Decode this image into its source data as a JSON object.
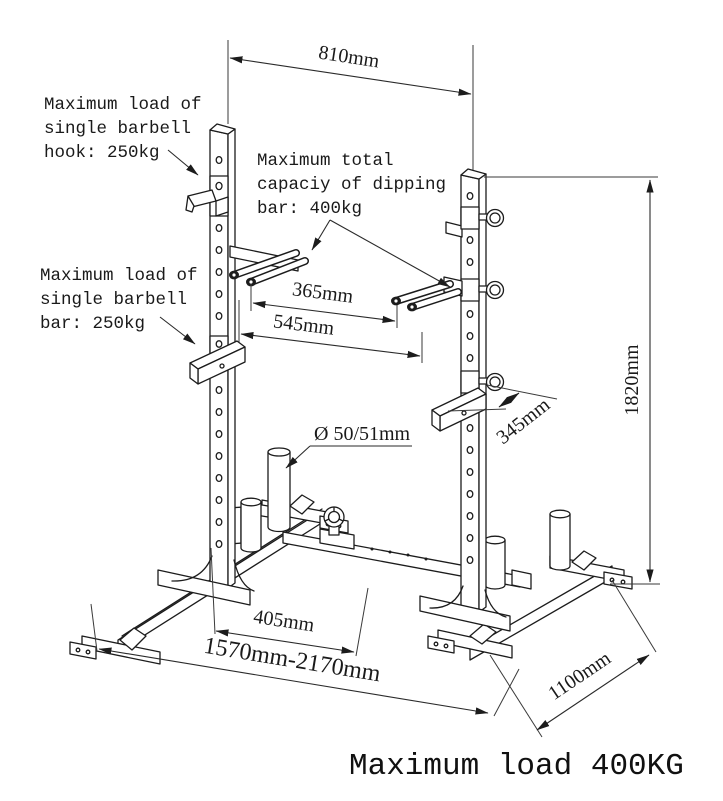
{
  "diagram_title": "squat rack dimension drawing",
  "colors": {
    "line": "#1c1c1c",
    "dimension": "#2a2a2a",
    "background": "#ffffff",
    "text": "#1a1a1a"
  },
  "labels": {
    "hook_load": {
      "lines": [
        "Maximum load of",
        "single barbell",
        "hook: 250kg"
      ]
    },
    "dipping_capacity": {
      "lines": [
        "Maximum total",
        "capaciy of dipping",
        "bar: 400kg"
      ]
    },
    "bar_load": {
      "lines": [
        "Maximum load of",
        "single barbell",
        "bar: 250kg"
      ]
    },
    "post_diameter": {
      "text": "Ø 50/51mm"
    }
  },
  "dimensions": {
    "top_width": "810mm",
    "dip_inner_span": "365mm",
    "dip_outer_span": "545mm",
    "total_height": "1820mm",
    "arm_depth": "345mm",
    "base_inner_span": "405mm",
    "base_width_range": "1570mm-2170mm",
    "base_depth": "1100mm"
  },
  "footer": {
    "text": "Maximum load 400KG"
  }
}
